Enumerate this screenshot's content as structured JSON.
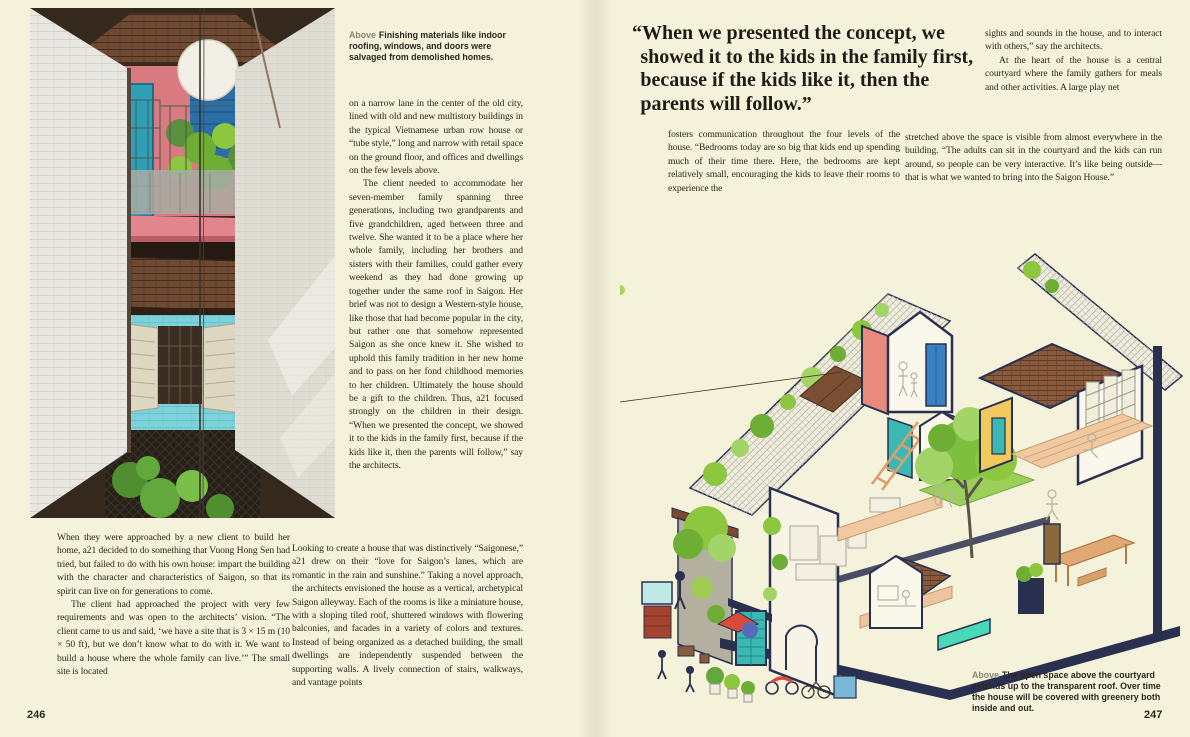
{
  "book": {
    "subject": "Saigon House by a21 studio",
    "palette": {
      "paper_cream": "#f4f2da",
      "ink": "#2b261e",
      "navy_outline": "#2a3050",
      "salmon_wall": "#e98a7e",
      "teal_accent": "#3bb8b4",
      "blue_door": "#3a7fc1",
      "yellow_wall": "#f2c95c",
      "leaf_green": "#8dc63f",
      "roof_brown": "#8a5a3c",
      "photo_pink": "#d97a80",
      "photo_turquoise": "#7ed2da"
    }
  },
  "left_page": {
    "page_number": "246",
    "photo_caption": {
      "label": "Above",
      "text": "Finishing materials like indoor roofing, windows, and doors were salvaged from demolished homes."
    },
    "mid_column": {
      "p1": "on a narrow lane in the center of the old city, lined with old and new multistory buildings in the typical Vietnamese urban row house or “tube style,” long and narrow with retail space on the ground floor, and offices and dwellings on the few levels above.",
      "p2": "The client needed to accommodate her seven-member family spanning three generations, including two grandparents and five grandchildren, aged between three and twelve. She wanted it to be a place where her whole family, including her brothers and sisters with their families, could gather every weekend as they had done growing up together under the same roof in Saigon. Her brief was not to design a Western-style house, like those that had become popular in the city, but rather one that somehow represented Saigon as she once knew it. She wished to uphold this family tradition in her new home and to pass on her fond childhood memories to her children. Ultimately the house should be a gift to the children. Thus, a21 focused strongly on the children in their design. “When we presented the concept, we showed it to the kids in the family first, because if the kids like it, then the parents will follow,” say the architects."
    },
    "bottom_left_column": {
      "p1": "When they were approached by a new client to build her home, a21 decided to do something that Vuong Hong Sen had tried, but failed to do with his own house: impart the building with the character and characteristics of Saigon, so that its spirit can live on for generations to come.",
      "p2": "The client had approached the project with very few requirements and was open to the architects’ vision. “The client came to us and said, ‘we have a site that is 3 × 15 m (10 × 50 ft), but we don’t know what to do with it. We want to build a house where the whole family can live.’” The small site is located"
    },
    "bottom_wide_column": {
      "p1": "Looking to create a house that was distinctively “Saigonese,” a21 drew on their “love for Saigon’s lanes, which are romantic in the rain and sunshine.” Taking a novel approach, the architects envisioned the house as a vertical, archetypical Saigon alleyway. Each of the rooms is like a miniature house, with a sloping tiled roof, shuttered windows with flowering balconies, and facades in a variety of colors and textures. Instead of being organized as a detached building, the small dwellings are independently suspended between the supporting walls. A lively connection of stairs, walkways, and vantage points"
    }
  },
  "right_page": {
    "page_number": "247",
    "pull_quote": "“When we presented the concept, we showed it to the kids in the family first, because if the kids like it, then the parents will follow.”",
    "quote_left_column": {
      "p1": "fosters communication throughout the four levels of the house. “Bedrooms today are so big that kids end up spending much of their time there. Here, the bedrooms are kept relatively small, encouraging the kids to leave their rooms to experience the"
    },
    "right_column": {
      "p1": "sights and sounds in the house, and to interact with others,” say the architects.",
      "p2": "At the heart of the house is a central courtyard where the family gathers for meals and other activities. A large play net"
    },
    "wide_column": {
      "p1": "stretched above the space is visible from almost everywhere in the building. “The adults can sit in the courtyard and the kids can run around, so people can be very interactive. It’s like being outside—that is what we wanted to bring into the Saigon House.”"
    },
    "illustration_caption": {
      "label": "Above",
      "text": "The open space above the courtyard extends up to the transparent roof. Over time the house will be covered with greenery both inside and out."
    }
  }
}
